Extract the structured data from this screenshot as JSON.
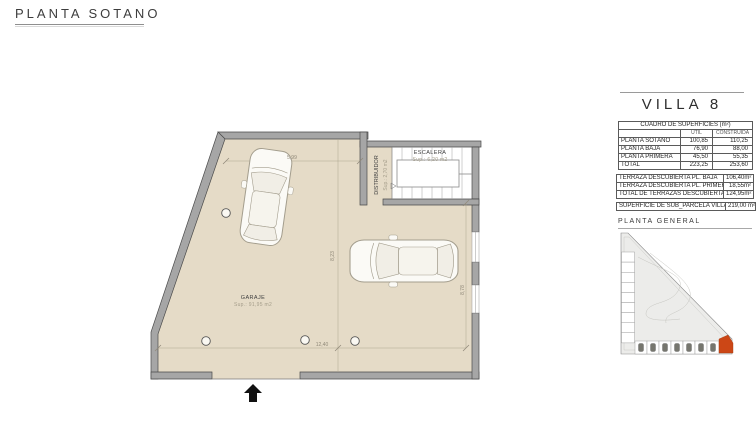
{
  "page": {
    "title": "PLANTA SOTANO"
  },
  "floor_plan": {
    "garaje_label": "GARAJE",
    "garaje_area": "Sup.: 91,95 m2",
    "escalera_label": "ESCALERA",
    "escalera_area": "Sup.: 6,20 m2",
    "distribuidor_label": "DISTRIBUIDOR",
    "distribuidor_area": "Sup.: 2,70 m2",
    "dim_top": "5,99",
    "dim_center_vertical": "8,23",
    "dim_bottom": "12,40",
    "dim_right_vertical": "8,78"
  },
  "side_panel": {
    "villa_title": "VILLA 8",
    "surfaces_table": {
      "title": "CUADRO DE SUPERFICIES (m²)",
      "col_headers": [
        "UTIL",
        "CONSTRUIDA"
      ],
      "rows": [
        {
          "label": "PLANTA SOTANO",
          "util": "100,85",
          "construida": "110,25"
        },
        {
          "label": "PLANTA BAJA",
          "util": "76,90",
          "construida": "88,00"
        },
        {
          "label": "PLANTA PRIMERA",
          "util": "45,50",
          "construida": "55,35"
        },
        {
          "label": "TOTAL",
          "util": "223,25",
          "construida": "253,60"
        }
      ]
    },
    "terrace_rows": [
      {
        "label": "TERRAZA DESCUBIERTA PL. BAJA",
        "value": "106,40m²"
      },
      {
        "label": "TERRAZA DESCUBIERTA PL. PRIMERA",
        "value": "18,55m²"
      },
      {
        "label": "TOTAL DE TERRAZAS DESCUBIERTAS",
        "value": "124,95m²"
      }
    ],
    "parcel_row": {
      "label": "SUPERFICIE DE SUB_PARCELA VILLA 8",
      "value": "219,00 m²"
    },
    "site_plan_title": "PLANTA GENERAL"
  },
  "colors": {
    "floor": "#e5dbc7",
    "wall": "#a6a6a6",
    "wall_edge": "#4a4a4a",
    "highlight_unit": "#cc4716",
    "site_fill": "#ececea"
  }
}
